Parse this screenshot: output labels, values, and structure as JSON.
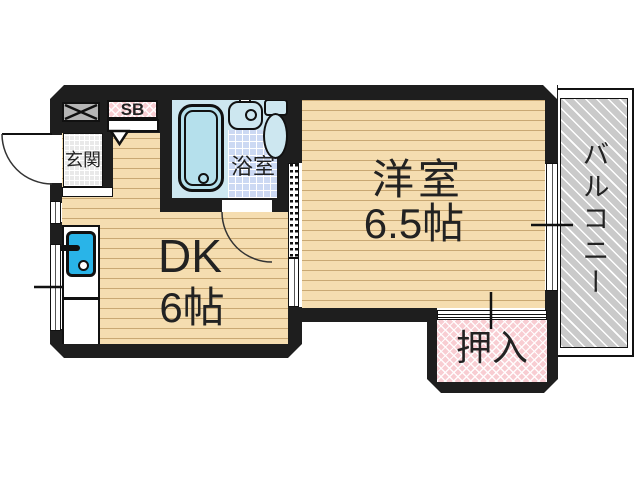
{
  "plan": {
    "type": "japanese-apartment-floorplan-1DK",
    "rooms": {
      "genkan": {
        "label": "玄関"
      },
      "shoe_box": {
        "label": "SB"
      },
      "bathroom": {
        "label": "浴室"
      },
      "dining_kitchen": {
        "label": "DK",
        "size": "6帖"
      },
      "western_room": {
        "label": "洋室",
        "size": "6.5帖"
      },
      "closet": {
        "label": "押入"
      },
      "balcony": {
        "label": "バルコニー"
      }
    },
    "colors": {
      "wall": "#1e1e1e",
      "floor": "#f5ddb0",
      "floor_plank_line": "#c9a873",
      "bath_tile": "#ccd9f3",
      "fixture_fill": "#cde7f0",
      "bathtub_fill": "#b5e0ec",
      "kitchen_sink": "#29b4e8",
      "closet_pink": "#f8cdd2",
      "genkan_tile": "#e9e9e9",
      "balcony_gray": "#cacaca"
    }
  }
}
